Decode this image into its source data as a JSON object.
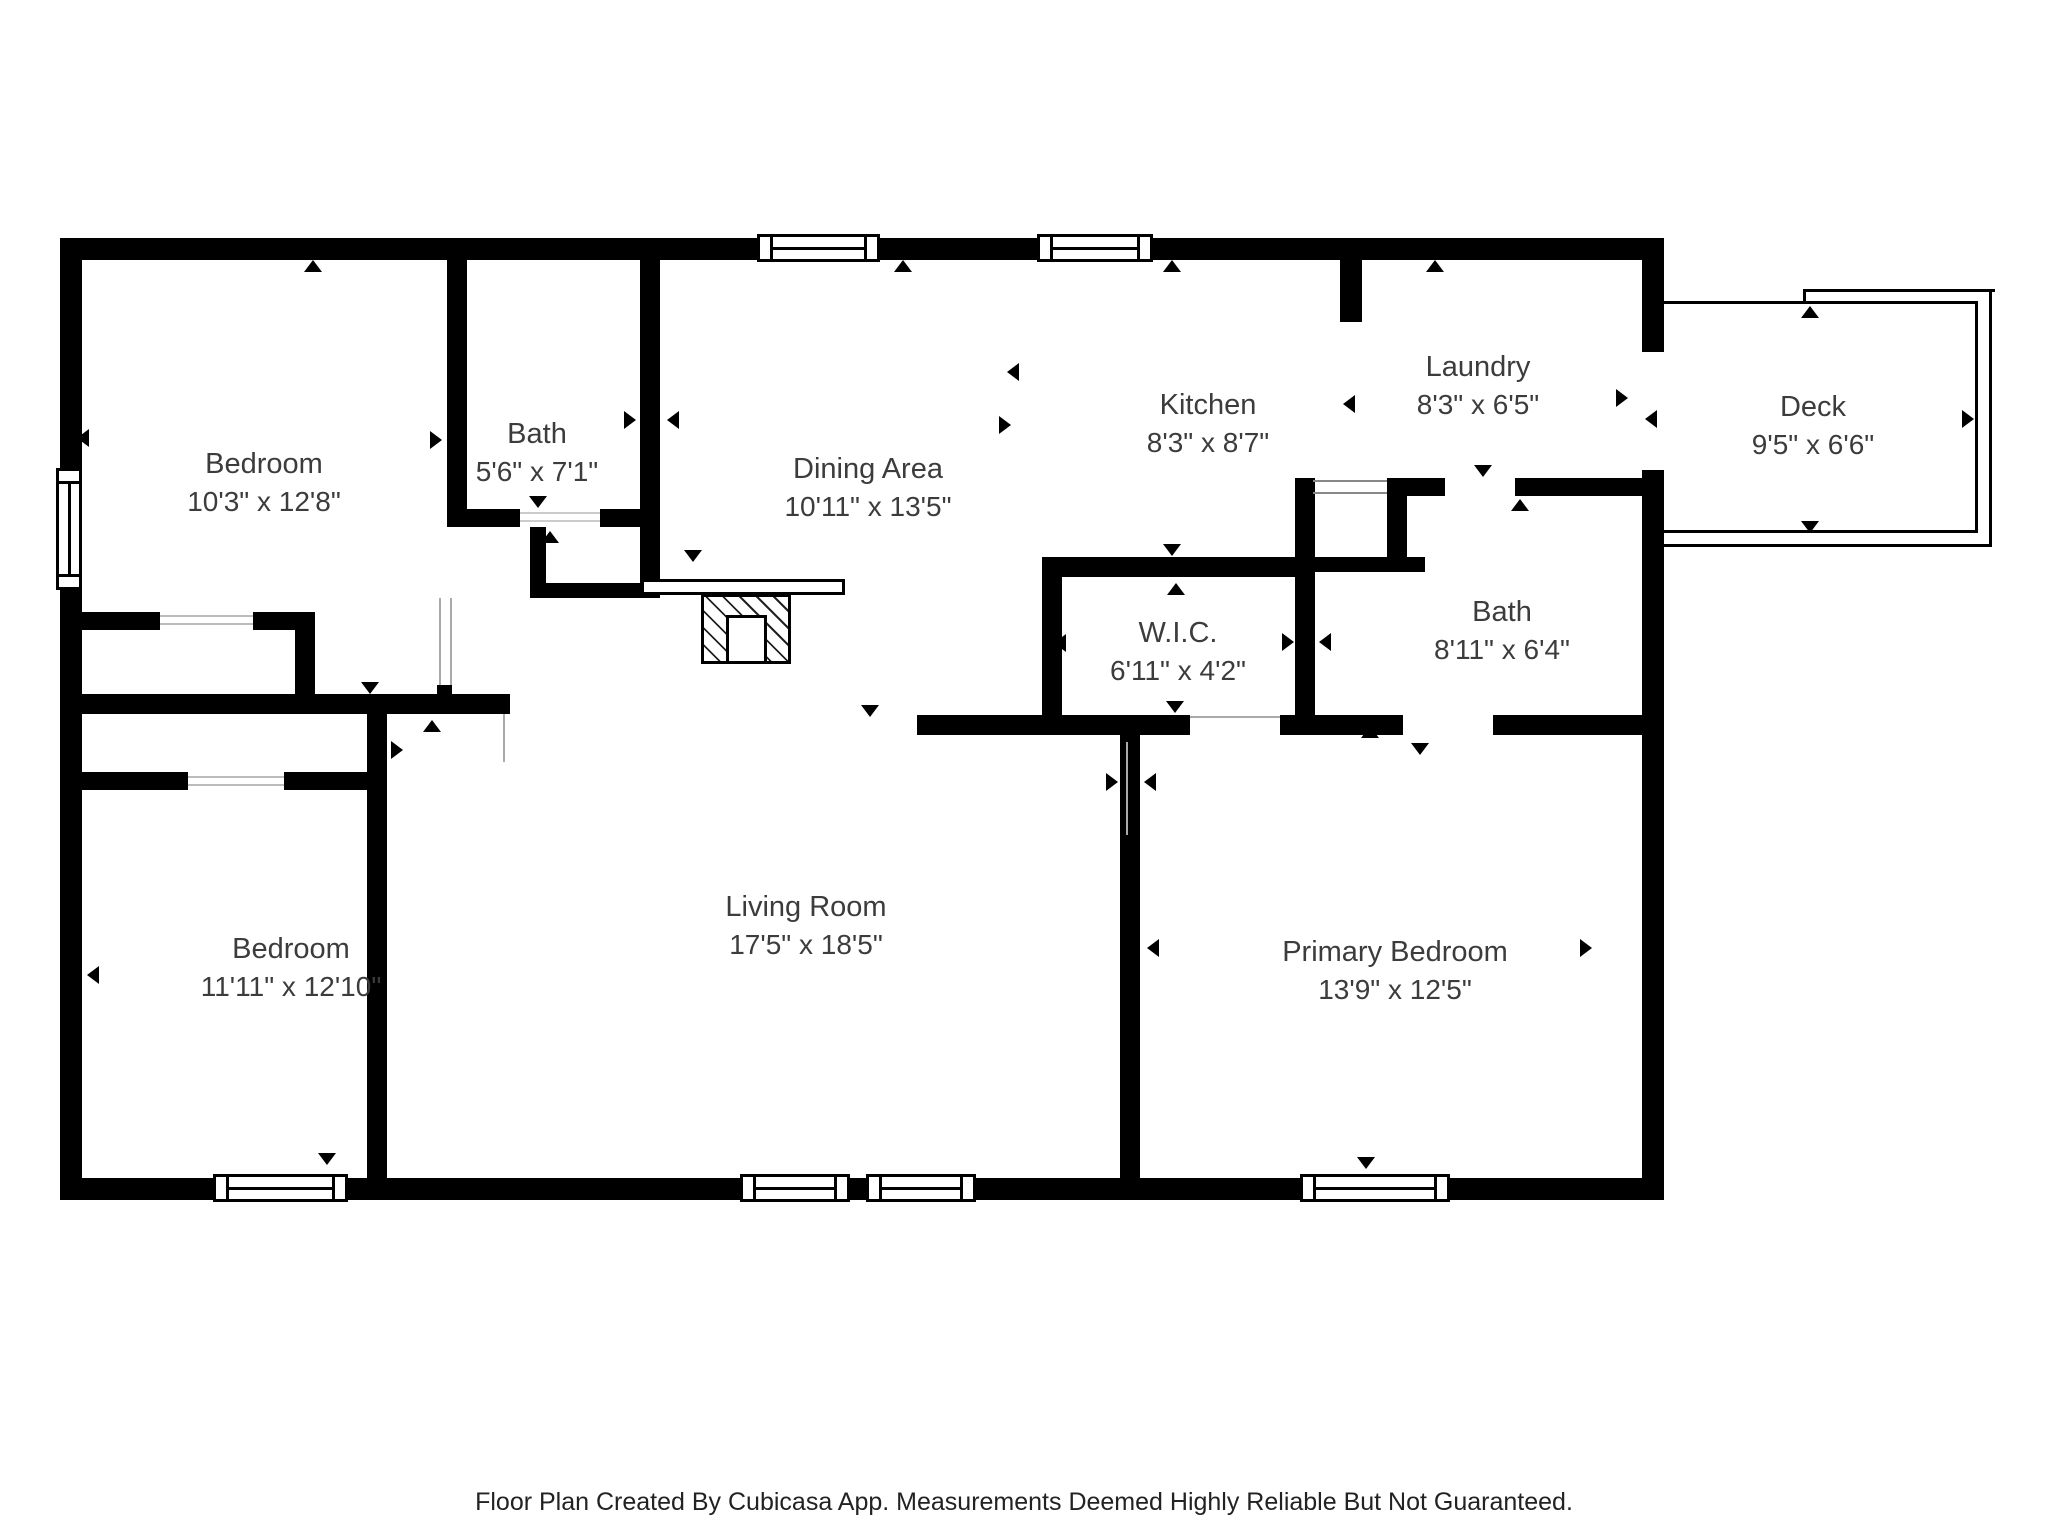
{
  "colors": {
    "walls": "#000000",
    "label_text": "#3c3c3c",
    "footer_text": "#222222",
    "background": "#ffffff"
  },
  "rooms": [
    {
      "name": "Bedroom",
      "dims": "10'3\" x 12'8\""
    },
    {
      "name": "Bath",
      "dims": "5'6\" x 7'1\""
    },
    {
      "name": "Dining Area",
      "dims": "10'11\" x 13'5\""
    },
    {
      "name": "Kitchen",
      "dims": "8'3\" x 8'7\""
    },
    {
      "name": "Laundry",
      "dims": "8'3\" x 6'5\""
    },
    {
      "name": "Deck",
      "dims": "9'5\" x 6'6\""
    },
    {
      "name": "W.I.C.",
      "dims": "6'11\" x 4'2\""
    },
    {
      "name": "Bath",
      "dims": "8'11\" x 6'4\""
    },
    {
      "name": "Living Room",
      "dims": "17'5\" x 18'5\""
    },
    {
      "name": "Bedroom",
      "dims": "11'11\" x 12'10\""
    },
    {
      "name": "Primary Bedroom",
      "dims": "13'9\" x 12'5\""
    }
  ],
  "footer": {
    "text": "Floor Plan Created By Cubicasa App. Measurements Deemed Highly Reliable But Not Guaranteed."
  }
}
